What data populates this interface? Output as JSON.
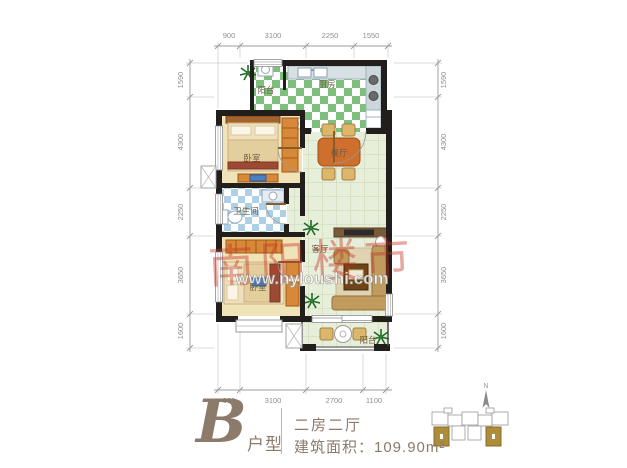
{
  "caption": {
    "unit_letter": "B",
    "unit_suffix": "户型",
    "layout_type": "二房二厅",
    "area": "建筑面积：109.90m²"
  },
  "rooms": [
    {
      "key": "balcony-top",
      "label": "阳台"
    },
    {
      "key": "kitchen",
      "label": "厨房"
    },
    {
      "key": "bedroom-upper",
      "label": "卧室"
    },
    {
      "key": "dining",
      "label": "餐厅"
    },
    {
      "key": "bathroom",
      "label": "卫生间"
    },
    {
      "key": "bedroom-lower",
      "label": "卧室"
    },
    {
      "key": "living",
      "label": "客厅"
    },
    {
      "key": "balcony-bottom",
      "label": "阳台"
    }
  ],
  "dims": {
    "top": [
      "900",
      "3100",
      "2250",
      "1550"
    ],
    "bottom": [
      "900",
      "3100",
      "2700",
      "1100"
    ],
    "left": [
      "1590",
      "4300",
      "2250",
      "3650",
      "1600"
    ],
    "right": [
      "1590",
      "4300",
      "2250",
      "3650",
      "1600"
    ]
  },
  "watermark": {
    "seal": "南阳楼市",
    "url": "www.nyloushi.com"
  },
  "keyplan": {
    "north": "N"
  },
  "colors": {
    "wall": "#221e1b",
    "kitchen_tile": "#7ebf7e",
    "bath_tile": "#aecfe6",
    "hall_tile": "#e7eed9",
    "bedroom_floor": "#f1e3b8",
    "furniture_orange": "#d78838",
    "caption_text": "#8c7a6a",
    "keyplan_gold": "#ad8c3a",
    "watermark_red": "#c23524"
  }
}
